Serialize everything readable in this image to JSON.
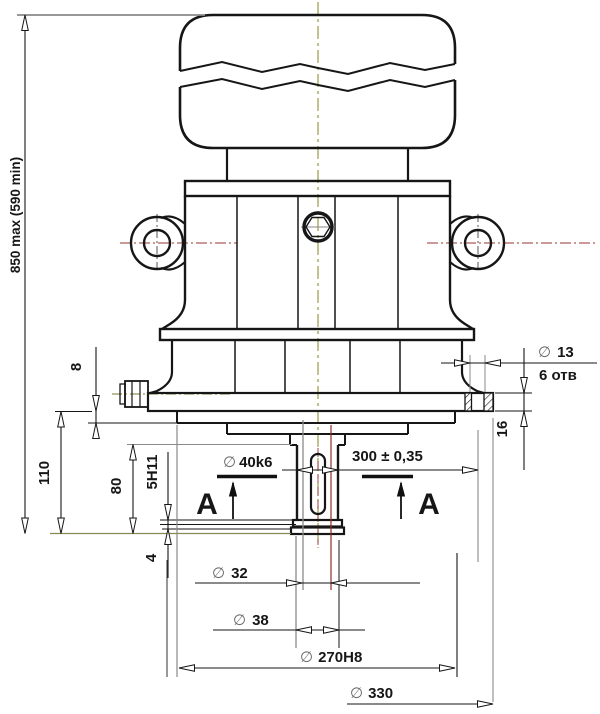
{
  "drawing": {
    "type": "engineering-drawing-front-view-with-section-marks",
    "symbols": {
      "diameter": "∅"
    },
    "labels": {
      "overall_height": "850 max (590 min)",
      "dim_8": "8",
      "dim_110": "110",
      "dim_80": "80",
      "keyway": "5H11",
      "dim_4": "4",
      "shaft_dia_value": "40k6",
      "length_300": "300 ± 0,35",
      "hole_dia_value": "13",
      "hole_count": "6 отв",
      "dim_16": "16",
      "dia_32_value": "32",
      "dia_38_value": "38",
      "dia_270_value": "270H8",
      "dia_330_value": "330",
      "section_a": "A"
    },
    "colors": {
      "line": "#161616",
      "extension": "#8a8a8a",
      "axis_olive": "#8f8f2f",
      "centerline_red": "#993333",
      "accent_red": "#8b3030",
      "background": "#ffffff"
    }
  }
}
